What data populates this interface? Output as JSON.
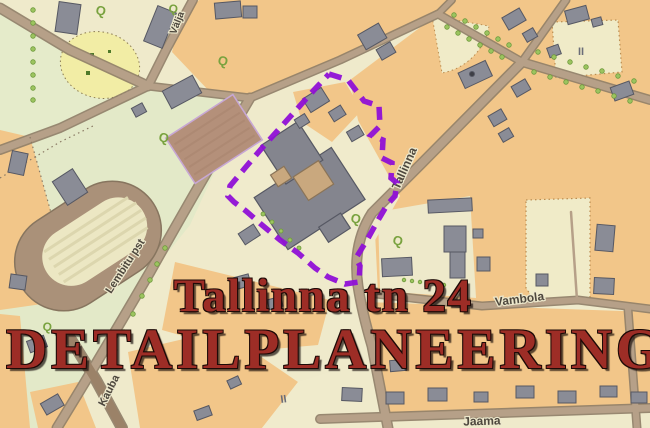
{
  "title_overlay": {
    "line1": "Tallinna tn 24",
    "line2": "DETAILPLANEERING"
  },
  "streets": {
    "valja": "Välja",
    "tallinna": "Tallinna",
    "lembitu": "Lembitu pst",
    "kauba": "Kauba",
    "vambola": "Vambola",
    "jaama": "Jaama"
  },
  "map_symbols": {
    "tree": "Q",
    "storeys": "II"
  },
  "colors": {
    "boundary_purple": "#8F10D6",
    "title_red": "#9D2D26",
    "block_orange": "#F2C689",
    "parcel_cream": "#F0EBCC",
    "park_green": "#E4EACA",
    "road_brown": "#B6A088",
    "building_gray": "#8A8C96",
    "track_brown": "#AA9179"
  }
}
